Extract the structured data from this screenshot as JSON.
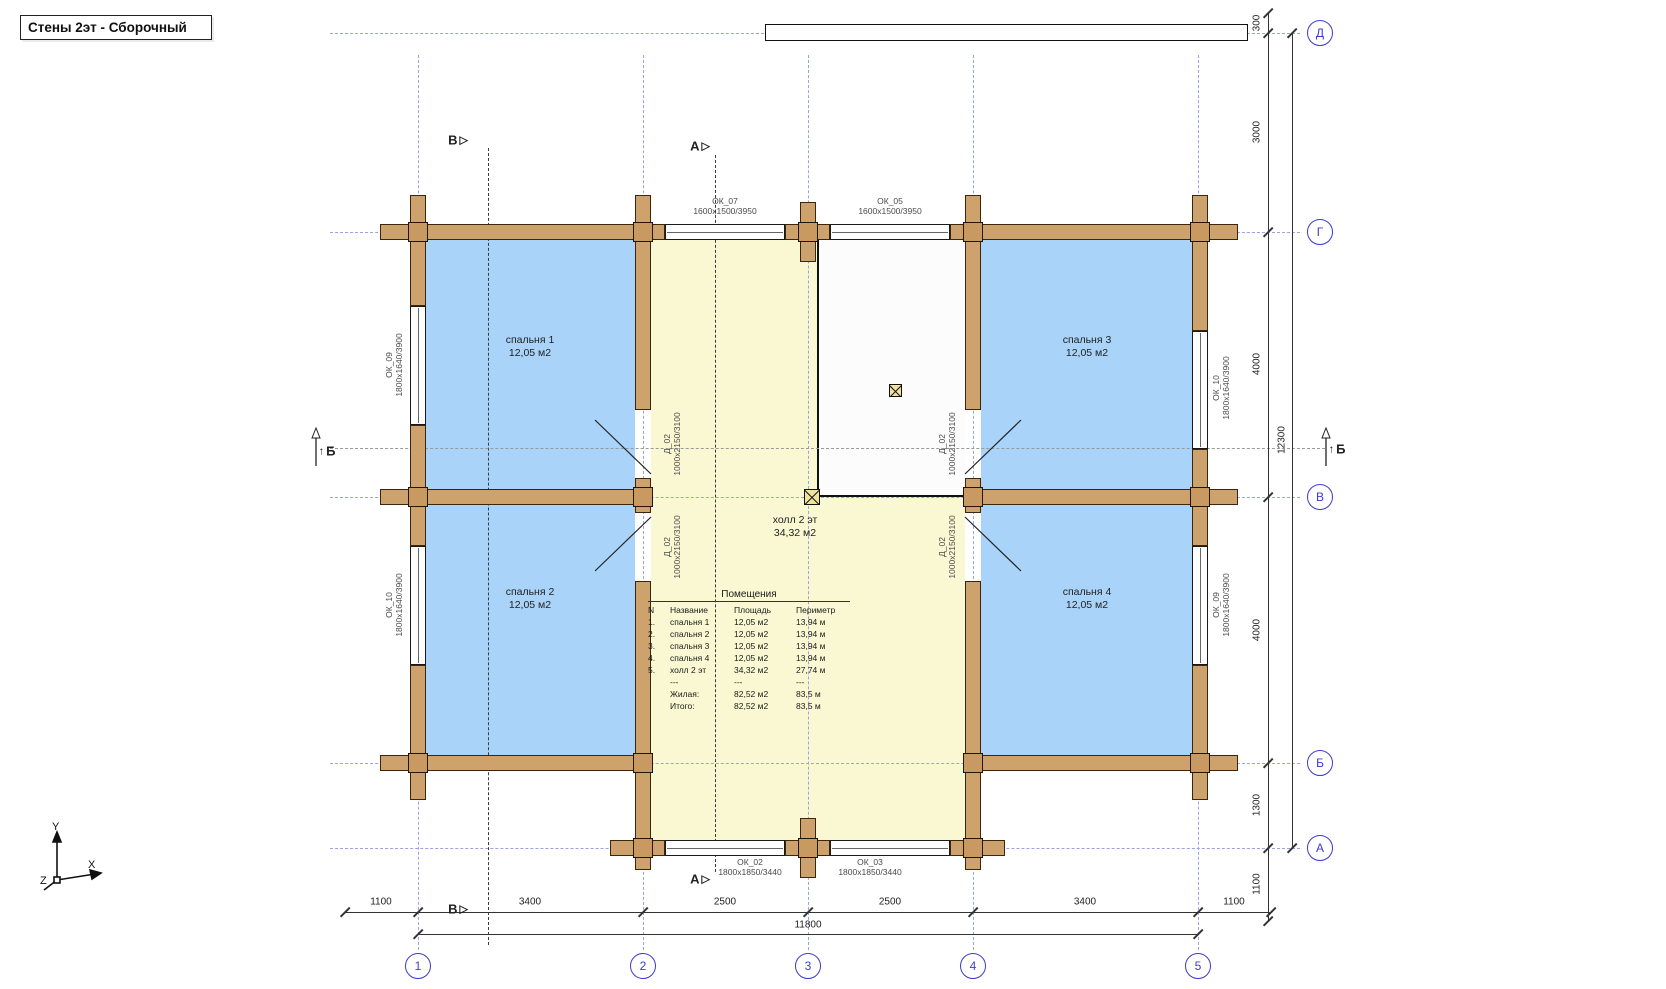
{
  "title": "Стены 2эт - Сборочный",
  "axis": {
    "cols": [
      "1",
      "2",
      "3",
      "4",
      "5"
    ],
    "rows": [
      "Д",
      "Г",
      "В",
      "Б",
      "А"
    ]
  },
  "dims": {
    "bottom": [
      "1100",
      "3400",
      "2500",
      "2500",
      "3400",
      "1100"
    ],
    "bottom_total": "11800",
    "right": [
      "300",
      "3000",
      "4000",
      "4000",
      "1300",
      "1100"
    ],
    "right_total": "12300"
  },
  "rooms": [
    {
      "name": "спальня 1",
      "area": "12,05 м2"
    },
    {
      "name": "спальня 2",
      "area": "12,05 м2"
    },
    {
      "name": "спальня 3",
      "area": "12,05 м2"
    },
    {
      "name": "спальня 4",
      "area": "12,05 м2"
    },
    {
      "name": "холл 2 эт",
      "area": "34,32 м2"
    }
  ],
  "windows": [
    {
      "id": "ОК_07",
      "size": "1600х1500/3950"
    },
    {
      "id": "ОК_05",
      "size": "1600х1500/3950"
    },
    {
      "id": "ОК_09",
      "size": "1800х1640/3900"
    },
    {
      "id": "ОК_10",
      "size": "1800х1640/3900"
    },
    {
      "id": "ОК_10",
      "size": "1800х1640/3900"
    },
    {
      "id": "ОК_09",
      "size": "1800х1640/3900"
    },
    {
      "id": "ОК_02",
      "size": "1800х1850/3440"
    },
    {
      "id": "ОК_03",
      "size": "1800х1850/3440"
    }
  ],
  "door": {
    "id": "Д_02",
    "size": "1000х2150/3100"
  },
  "sections": {
    "a": "А",
    "b": "Б",
    "v": "В"
  },
  "glyphs": {
    "section_arrow": "▷",
    "up_arrow": "↑"
  },
  "table": {
    "title": "Помещения",
    "headers": {
      "num": "N",
      "name": "Название",
      "area": "Площадь",
      "perimeter": "Периметр"
    },
    "rows": [
      {
        "num": "1.",
        "name": "спальня 1",
        "area": "12,05 м2",
        "perimeter": "13,94 м"
      },
      {
        "num": "2.",
        "name": "спальня 2",
        "area": "12,05 м2",
        "perimeter": "13,94 м"
      },
      {
        "num": "3.",
        "name": "спальня 3",
        "area": "12,05 м2",
        "perimeter": "13,94 м"
      },
      {
        "num": "4.",
        "name": "спальня 4",
        "area": "12,05 м2",
        "perimeter": "13,94 м"
      },
      {
        "num": "5.",
        "name": "холл 2 эт",
        "area": "34,32 м2",
        "perimeter": "27,74 м"
      },
      {
        "num": "",
        "name": "---",
        "area": "---",
        "perimeter": "---"
      },
      {
        "num": "",
        "name": "Жилая:",
        "area": "82,52 м2",
        "perimeter": "83,5 м"
      },
      {
        "num": "",
        "name": "Итого:",
        "area": "82,52 м2",
        "perimeter": "83,5 м"
      }
    ]
  },
  "ucs": {
    "x": "X",
    "y": "Y",
    "z": "Z"
  },
  "colors": {
    "room_blue": "#a9d3f8",
    "hall_yellow": "#f9f8d2",
    "wall_tan": "#cda26c",
    "axis_blue": "#3c3ccb",
    "grid_periwinkle": "#9aa2e2"
  }
}
